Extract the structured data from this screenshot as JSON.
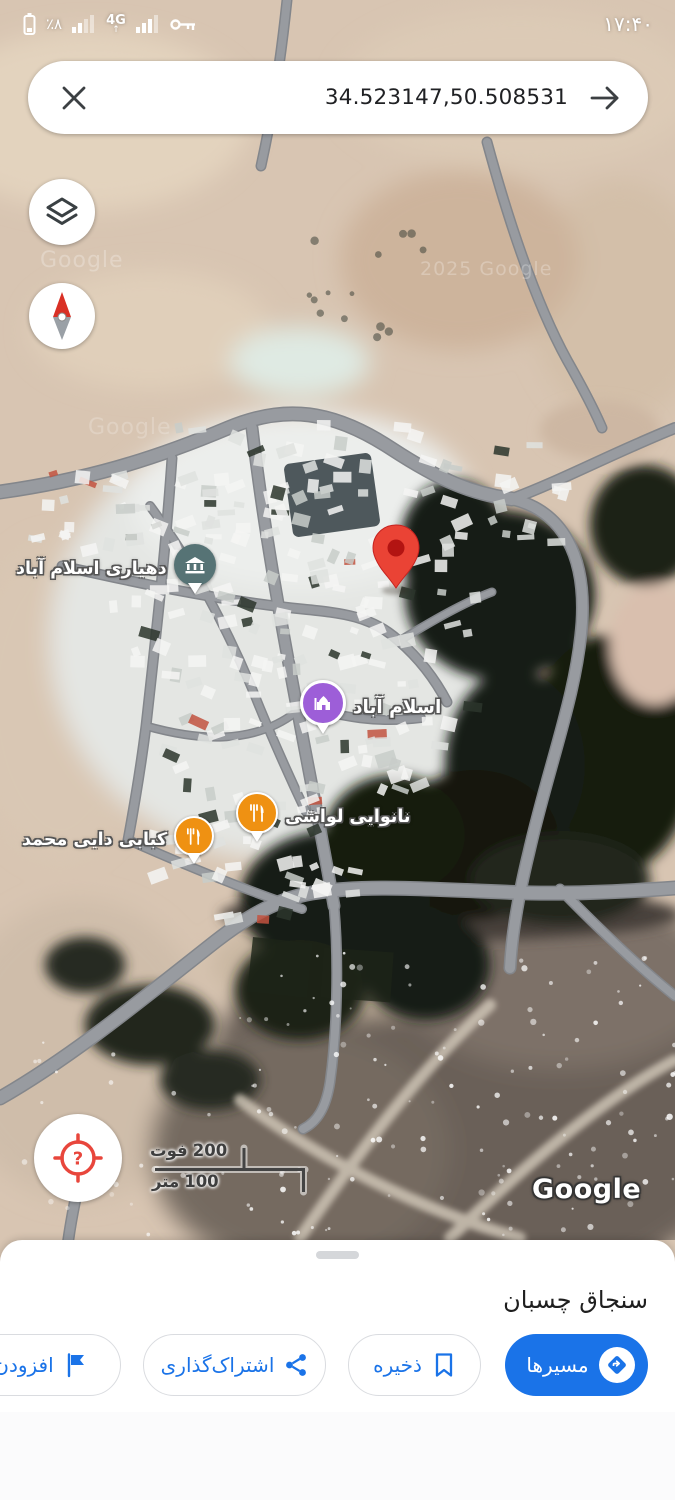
{
  "status_bar": {
    "time": "۱۷:۴۰",
    "battery_percent": "٪۸",
    "network_label": "4G",
    "network_arrow": "↑"
  },
  "search_bar": {
    "query": "34.523147,50.508531"
  },
  "map": {
    "pois": {
      "village_office": {
        "label": "دهیاری اسلام آباد"
      },
      "mosque": {
        "label": "اسلام آباد"
      },
      "bakery": {
        "label": "نانوایی لواشی"
      },
      "kebab": {
        "label": "کبابی دایی محمد"
      }
    },
    "scale_bar": {
      "feet_unit": "فوت",
      "feet_value": "200",
      "meters_unit": "متر",
      "meters_value": "100"
    },
    "watermark_google": "Google",
    "watermark_copyright": "2025 Google",
    "logo": "Google"
  },
  "bottom_sheet": {
    "title": "سنجاق چسبان",
    "buttons": {
      "directions": {
        "label": "مسیرها"
      },
      "save": {
        "label": "ذخیره"
      },
      "share": {
        "label": "اشتراک‌گذاری"
      },
      "add_label": {
        "label": "افزودن بر"
      }
    }
  },
  "colors": {
    "primary_blue": "#1a73e8",
    "pin_red": "#ea4335",
    "poi_orange": "#ef9112",
    "poi_purple": "#9d5ed8",
    "poi_teal": "#567375",
    "road_gray": "#989ba0"
  }
}
